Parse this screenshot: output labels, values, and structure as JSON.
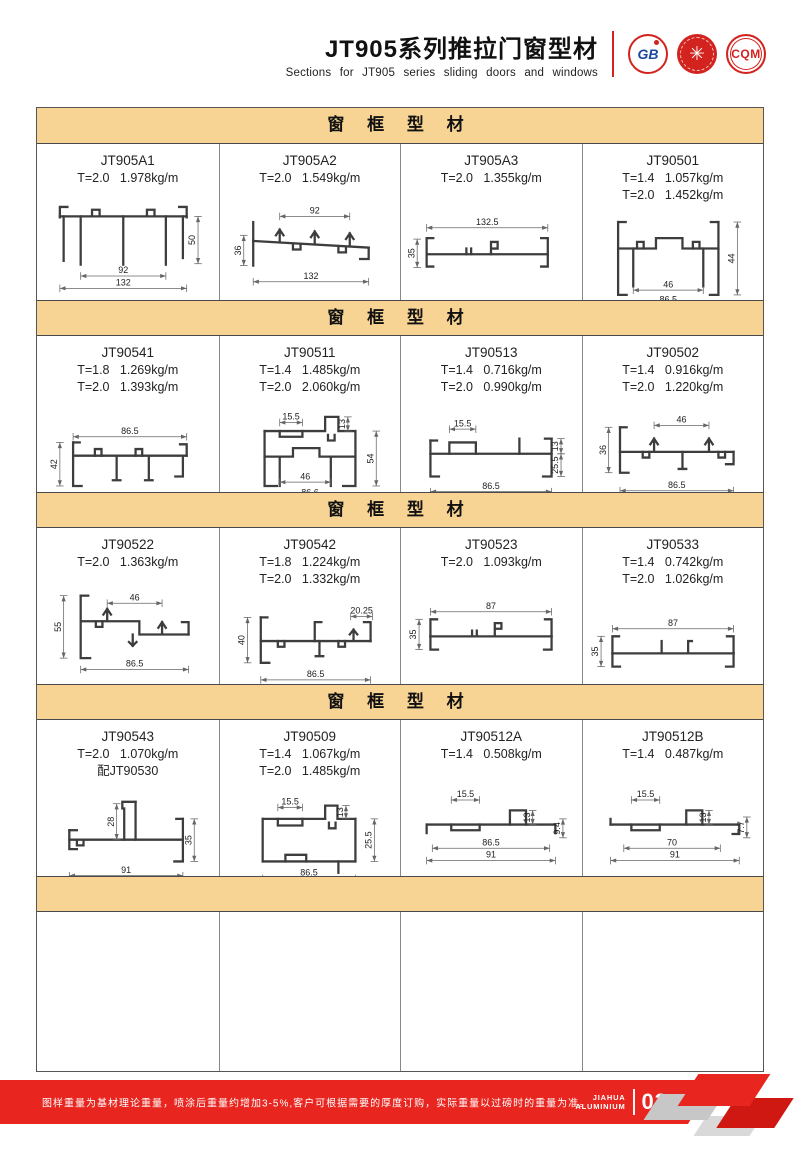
{
  "page": {
    "title": "JT905系列推拉门窗型材",
    "subtitle": "Sections for JT905 series sliding doors and windows"
  },
  "logos": {
    "gb_text": "GB",
    "stamp_glyph": "✳",
    "cqm_text": "CQM"
  },
  "sections": [
    {
      "label": "窗 框 型 材",
      "cells": [
        {
          "code": "JT905A1",
          "specs": [
            "T=2.0   1.978kg/m"
          ],
          "dims": [
            "50",
            "92",
            "132"
          ]
        },
        {
          "code": "JT905A2",
          "specs": [
            "T=2.0   1.549kg/m"
          ],
          "dims": [
            "92",
            "36",
            "132"
          ]
        },
        {
          "code": "JT905A3",
          "specs": [
            "T=2.0   1.355kg/m"
          ],
          "dims": [
            "132.5",
            "35"
          ]
        },
        {
          "code": "JT90501",
          "specs": [
            "T=1.4   1.057kg/m",
            "T=2.0   1.452kg/m"
          ],
          "dims": [
            "44",
            "46",
            "86.5"
          ]
        }
      ]
    },
    {
      "label": "窗 框 型 材",
      "cells": [
        {
          "code": "JT90541",
          "specs": [
            "T=1.8   1.269kg/m",
            "T=2.0   1.393kg/m"
          ],
          "dims": [
            "86.5",
            "42"
          ]
        },
        {
          "code": "JT90511",
          "specs": [
            "T=1.4   1.485kg/m",
            "T=2.0   2.060kg/m"
          ],
          "dims": [
            "15.5",
            "13",
            "54",
            "46",
            "86.6"
          ]
        },
        {
          "code": "JT90513",
          "specs": [
            "T=1.4   0.716kg/m",
            "T=2.0   0.990kg/m"
          ],
          "dims": [
            "15.5",
            "13",
            "25.5",
            "86.5"
          ]
        },
        {
          "code": "JT90502",
          "specs": [
            "T=1.4   0.916kg/m",
            "T=2.0   1.220kg/m"
          ],
          "dims": [
            "46",
            "36",
            "86.5"
          ]
        }
      ]
    },
    {
      "label": "窗 框 型 材",
      "cells": [
        {
          "code": "JT90522",
          "specs": [
            "T=2.0   1.363kg/m"
          ],
          "dims": [
            "55",
            "46",
            "86.5"
          ]
        },
        {
          "code": "JT90542",
          "specs": [
            "T=1.8   1.224kg/m",
            "T=2.0   1.332kg/m"
          ],
          "dims": [
            "40",
            "20.25",
            "86.5"
          ]
        },
        {
          "code": "JT90523",
          "specs": [
            "T=2.0   1.093kg/m"
          ],
          "dims": [
            "87",
            "35"
          ]
        },
        {
          "code": "JT90533",
          "specs": [
            "T=1.4   0.742kg/m",
            "T=2.0   1.026kg/m"
          ],
          "dims": [
            "87",
            "35"
          ]
        }
      ]
    },
    {
      "label": "窗 框 型 材",
      "cells": [
        {
          "code": "JT90543",
          "specs": [
            "T=2.0   1.070kg/m",
            "配JT90530"
          ],
          "dims": [
            "28",
            "35",
            "91"
          ]
        },
        {
          "code": "JT90509",
          "specs": [
            "T=1.4   1.067kg/m",
            "T=2.0   1.485kg/m"
          ],
          "dims": [
            "15.5",
            "13",
            "25.5",
            "86.5"
          ]
        },
        {
          "code": "JT90512A",
          "specs": [
            "T=1.4   0.508kg/m"
          ],
          "dims": [
            "15.5",
            "13",
            "9.4",
            "86.5",
            "91"
          ]
        },
        {
          "code": "JT90512B",
          "specs": [
            "T=1.4   0.487kg/m"
          ],
          "dims": [
            "15.5",
            "13",
            "7.7",
            "70",
            "91"
          ]
        }
      ]
    },
    {
      "label": "",
      "cells": [
        {},
        {},
        {},
        {}
      ]
    }
  ],
  "footer": {
    "note": "图样重量为基材理论重量，喷涂后重量约增加3-5%,客户可根据需要的厚度订购，实际重量以过磅时的重量为准。",
    "brand_top": "JIAHUA",
    "brand_bottom": "ALUMINIUM",
    "page_number": "03"
  }
}
